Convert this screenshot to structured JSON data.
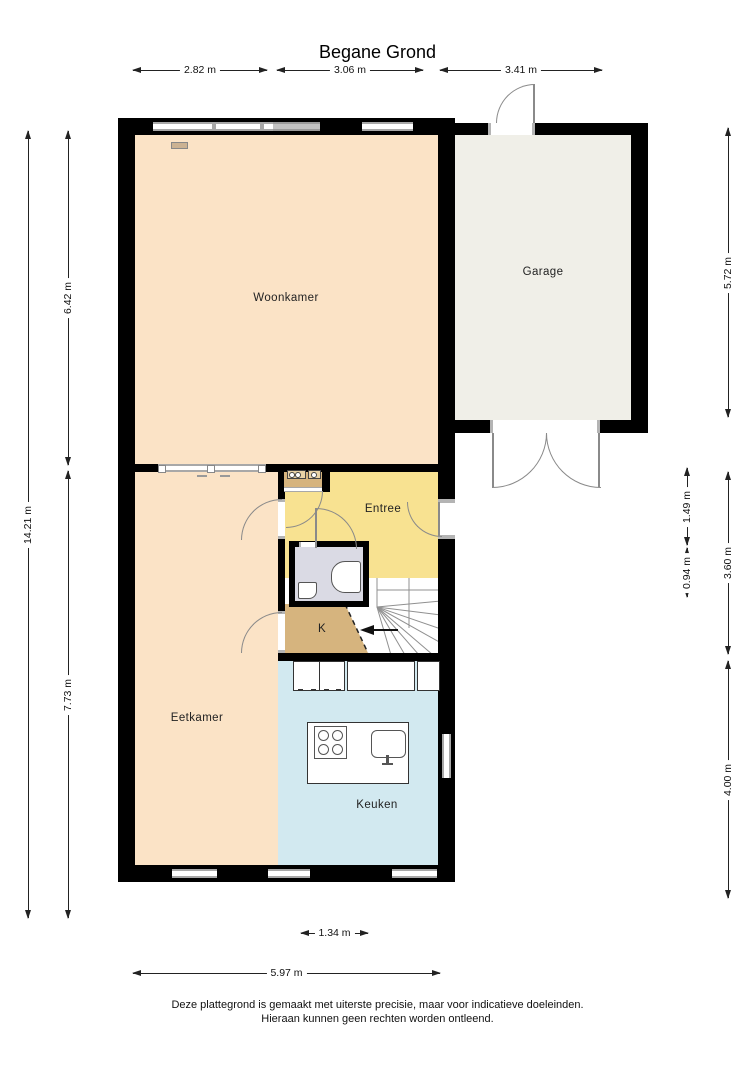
{
  "title": "Begane Grond",
  "rooms": {
    "woonkamer": "Woonkamer",
    "garage": "Garage",
    "entree": "Entree",
    "kast": "K",
    "eetkamer": "Eetkamer",
    "keuken": "Keuken"
  },
  "dims": {
    "top": [
      "2.82 m",
      "3.06 m",
      "3.41 m"
    ],
    "bottom": [
      "1.34 m",
      "5.97 m"
    ],
    "left": [
      "14.21 m",
      "6.42 m",
      "7.73 m"
    ],
    "right": [
      "5.72 m",
      "1.49 m",
      "0.94 m",
      "3.60 m",
      "4.00 m"
    ]
  },
  "footer": {
    "line1": "Deze plattegrond is gemaakt met uiterste precisie, maar voor indicatieve doeleinden.",
    "line2": "Hieraan kunnen geen rechten worden ontleend."
  },
  "colors": {
    "wall": "#000000",
    "living_dining_floor": "#fbe3c6",
    "entry_floor": "#f8e291",
    "garage_floor": "#f0efe8",
    "kitchen_floor": "#d2e9f0",
    "toilet_floor": "#dadae4",
    "closet_floor": "#d6b47e",
    "window_frame": "#a8a8a8"
  }
}
